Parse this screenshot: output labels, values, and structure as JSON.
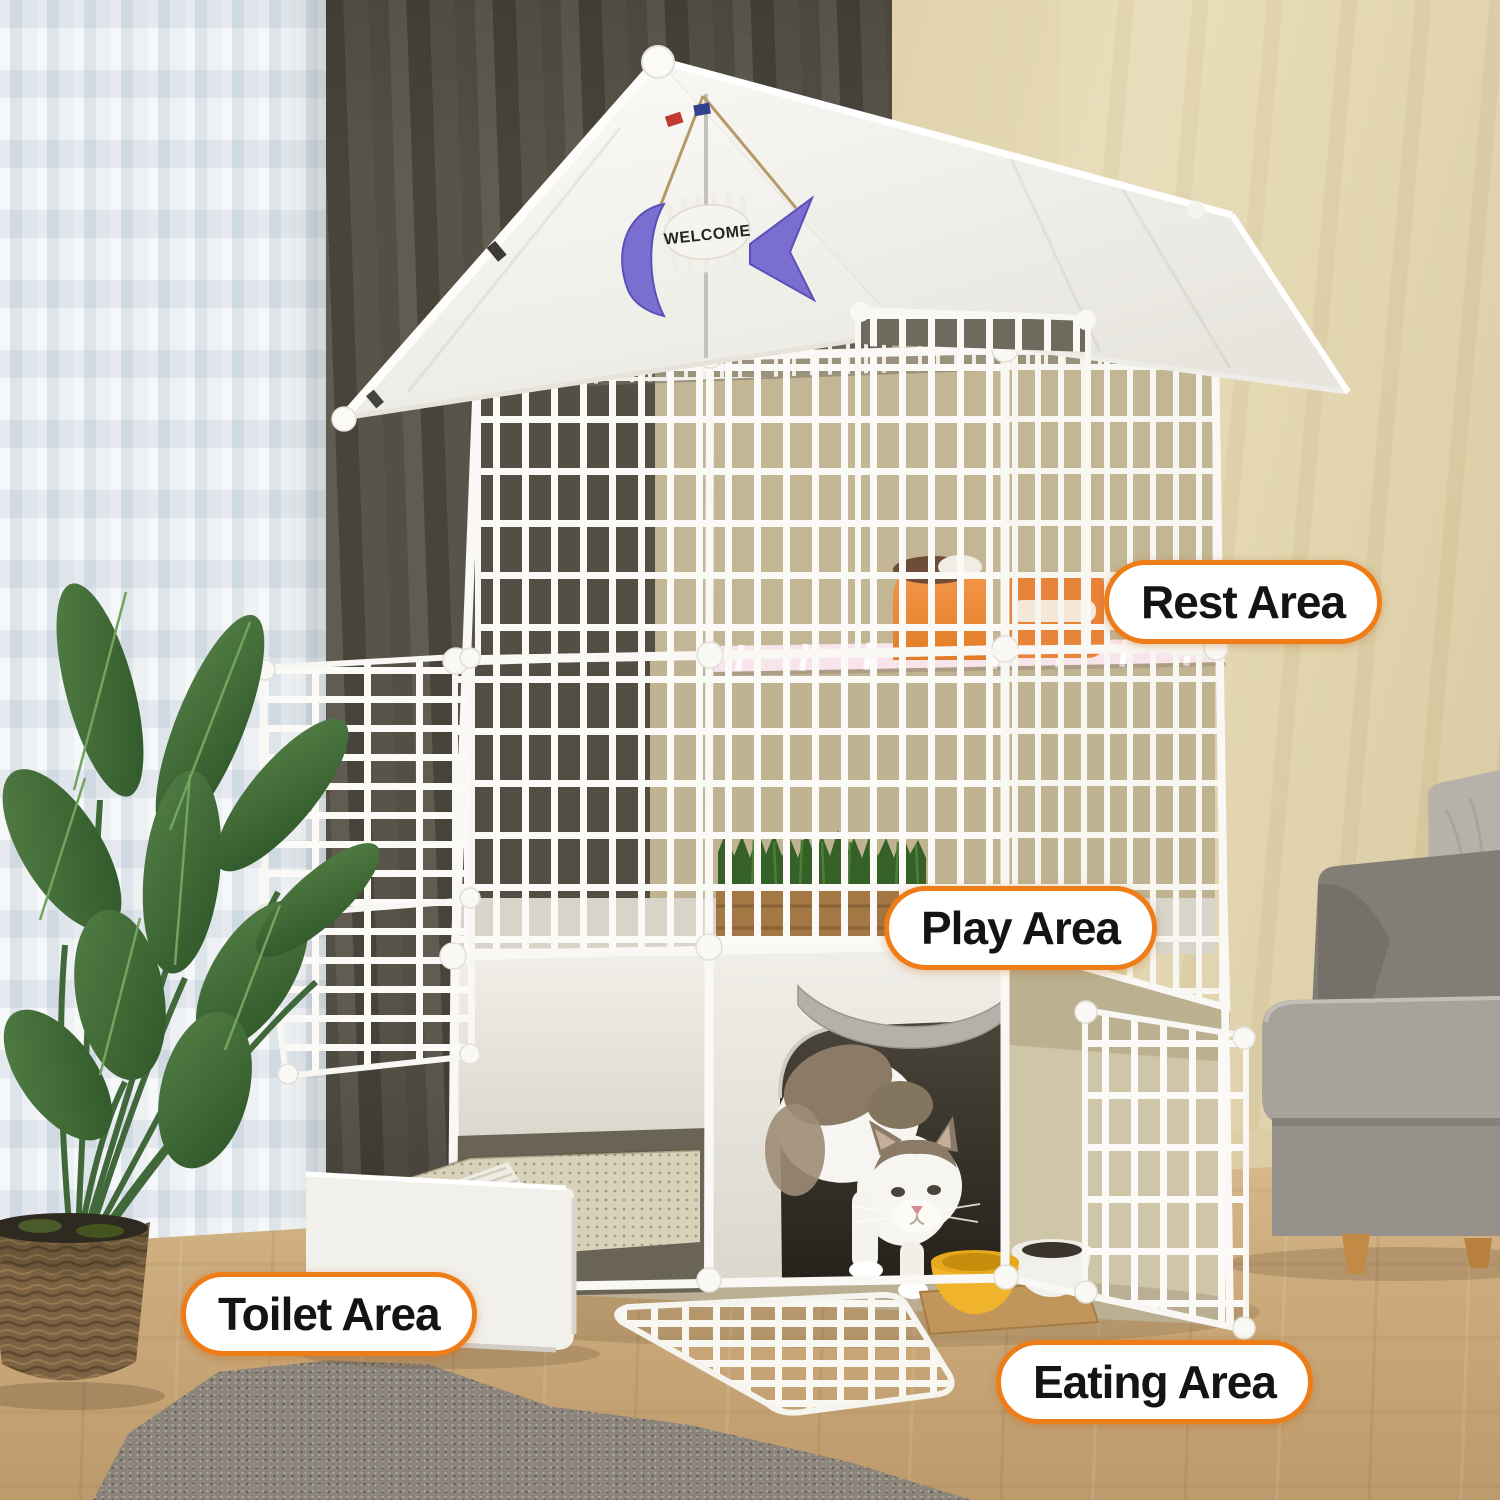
{
  "product_labels": {
    "rest": "Rest Area",
    "play": "Play Area",
    "toilet": "Toilet Area",
    "eating": "Eating Area"
  },
  "roof_sign": {
    "text": "WELCOME"
  },
  "colors": {
    "label_border": "#ee7d18",
    "label_background": "#ffffff",
    "label_text": "#141414",
    "cage_wire": "#fbfaf6",
    "roof_white": "#fbfaf7",
    "cat_bed_orange": "#ef8a3c",
    "food_bowl_yellow": "#f0b42c",
    "welcome_fish_purple": "#7a6fd0",
    "rest_mat_pink": "#f8e5eb"
  }
}
